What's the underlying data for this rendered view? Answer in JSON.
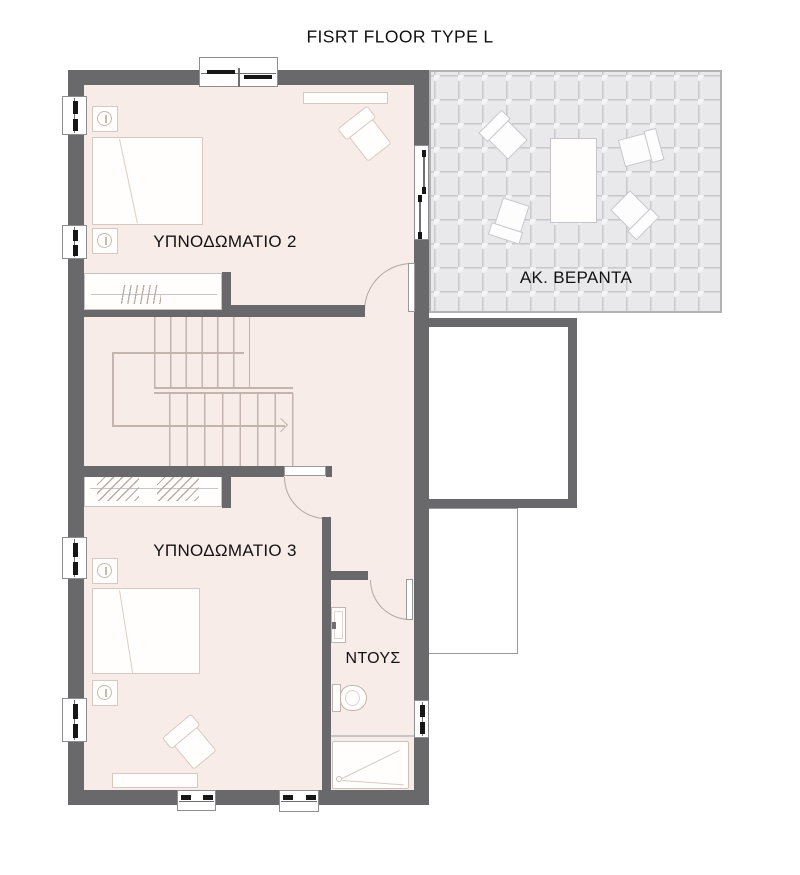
{
  "title": "FISRT FLOOR TYPE L",
  "rooms": {
    "bedroom2": {
      "label": "ΥΠΝΟΔΩΜΑΤΙΟ 2"
    },
    "bedroom3": {
      "label": "ΥΠΝΟΔΩΜΑΤΙΟ 3"
    },
    "shower": {
      "label": "ΝΤΟΥΣ"
    },
    "veranda": {
      "label": "ΑΚ. ΒΕΡΑΝΤΑ"
    }
  },
  "colors": {
    "wall": "#69696b",
    "floor": "#f8ece9",
    "tile_bg": "#e9e9eb",
    "tile_line": "#c8c8cb",
    "stair_line": "#c3b5ae",
    "furniture_border": "#d8c8c0",
    "label_text": "#121212"
  }
}
